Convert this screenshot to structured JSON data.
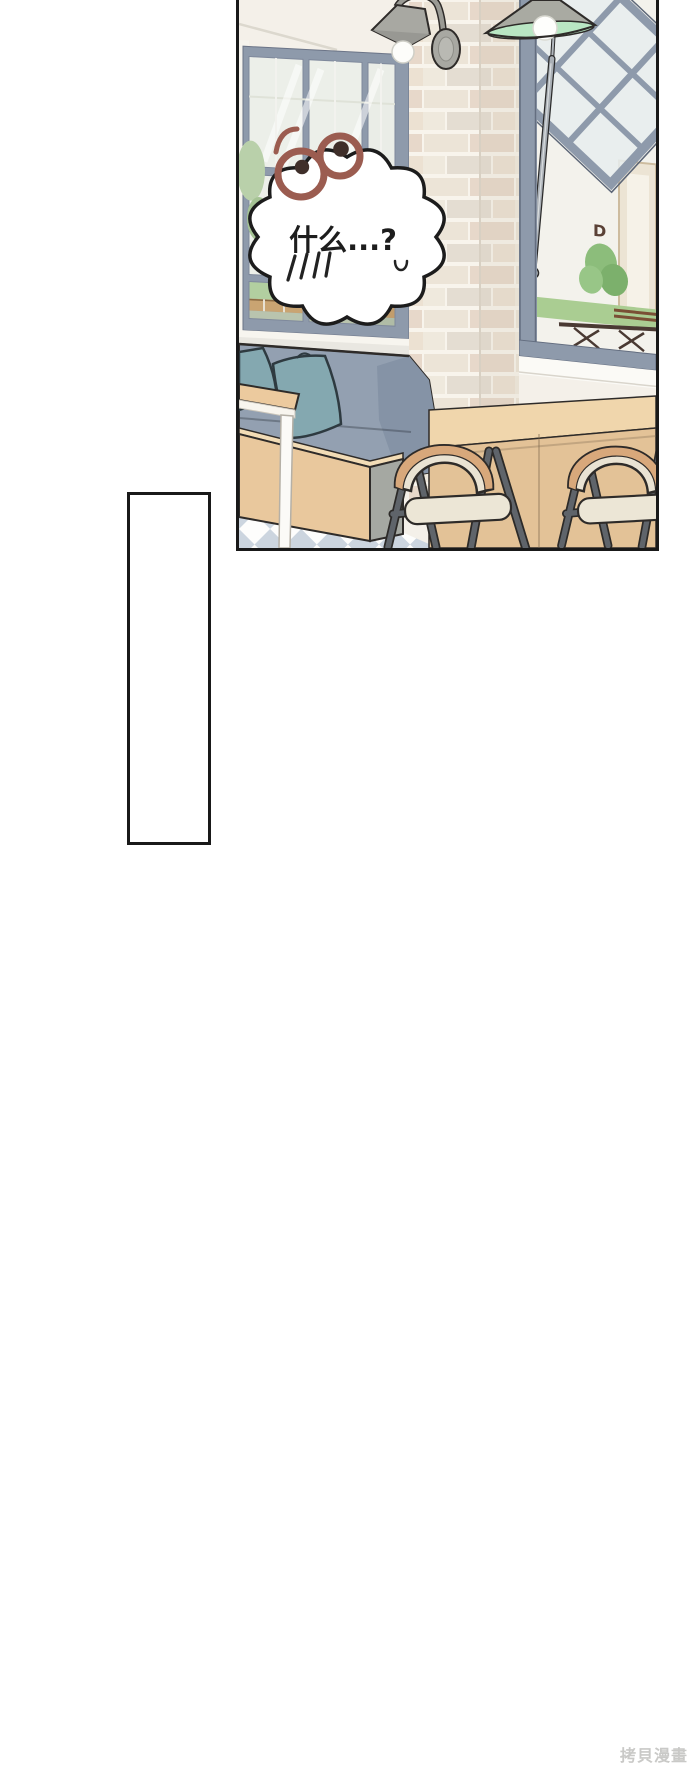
{
  "page": {
    "background_color": "#ffffff",
    "watermark": {
      "text": "拷貝漫畫",
      "color": "#c9c9c7"
    }
  },
  "main_panel": {
    "description": "cafe interior comic panel",
    "speech_bubble": {
      "text": "什么...?",
      "stress_marks": "||||",
      "mouth_mark": "u"
    },
    "surprised_eyes": {
      "ring_color": "#9b5c50",
      "pupil_color": "#3f2f2a"
    },
    "outside_sign_letter": "D",
    "palette": {
      "outline": "#2e2b29",
      "wall_cream": "#f4f0e9",
      "window_frame_blue": "#8e9aab",
      "glass": "#ecefe9",
      "brick_light": "#ece4d7",
      "brick_pink": "#e7d8ca",
      "brick_grout": "#f8f4ec",
      "bench_blue_gray": "#93a0b1",
      "pillow_teal": "#84a8b0",
      "wood_light": "#e9c89d",
      "counter_wood": "#e7c69c",
      "chair_back_tan": "#d8a87b",
      "chair_seat_cream": "#eae3d3",
      "chair_leg_gray": "#5f646a",
      "floor_check_blue": "#ccd5df",
      "lamp_gray": "#a9aaa2",
      "lamp_mint": "#b9e6c3",
      "greenery": "#8cbd7b"
    }
  },
  "empty_panel": {
    "content": ""
  }
}
